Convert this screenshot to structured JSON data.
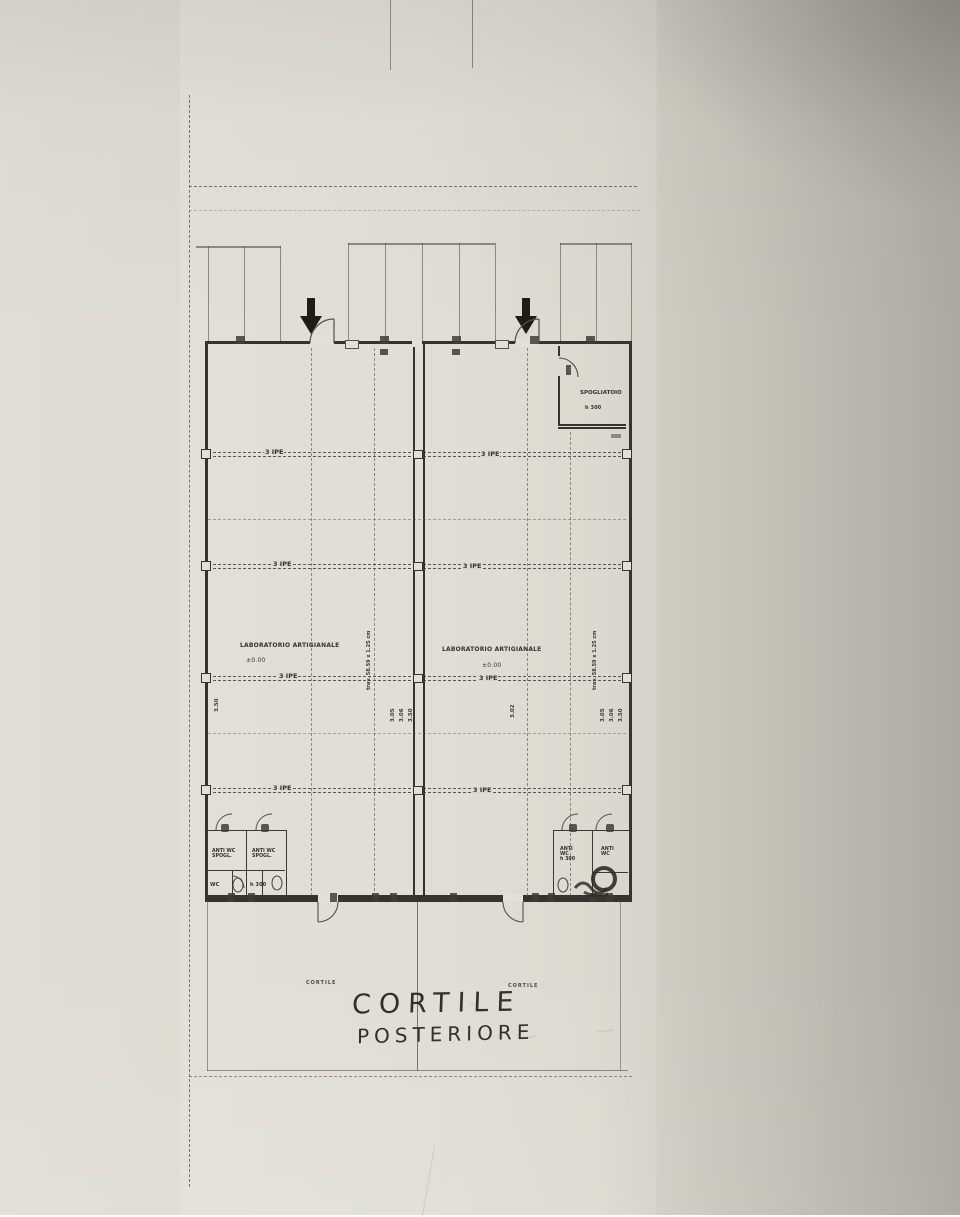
{
  "plan": {
    "labels": {
      "laboratorio": "LABORATORIO ARTIGIANALE",
      "level": "±0.00",
      "spogliatoio": "SPOGLIATOIO",
      "h300": "h 300",
      "beam": "3 IPE",
      "anti_wc": "ANTI WC",
      "spogl": "SPOGL.",
      "anti": "ANTI",
      "wc": "WC",
      "trav_note": "trav. 58.59 x 1.25 cm",
      "dim_350": "3.50",
      "dim_305": "3.05",
      "dim_306": "3.06",
      "dim_302": "3.02",
      "cortile_print": "CORTILE",
      "cortile_hand": "CORTILE",
      "posteriore_hand": "POSTERIORE"
    },
    "colors": {
      "paper": "#d6d4ca",
      "ink": "#34332e",
      "pencil": "#6b6a62"
    }
  }
}
